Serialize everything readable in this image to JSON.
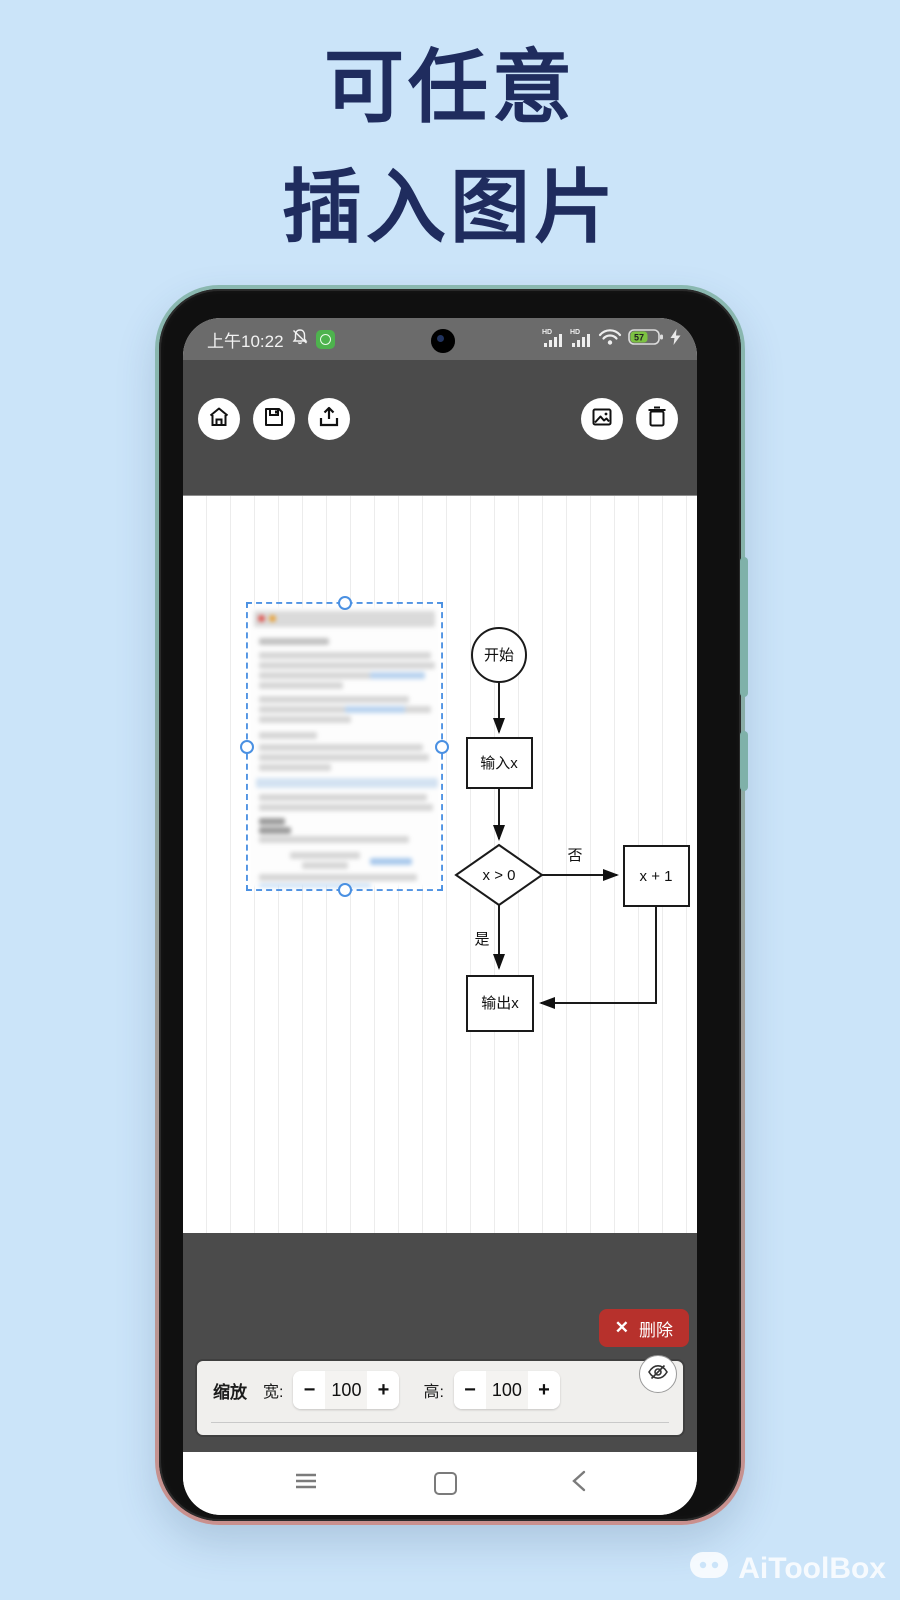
{
  "title": {
    "line1": "可任意",
    "line2": "插入图片"
  },
  "status_bar": {
    "time": "上午10:22",
    "hd": "HD",
    "battery_percent": "57"
  },
  "canvas": {
    "flowchart": {
      "start": "开始",
      "input": "输入x",
      "condition": "x > 0",
      "no": "否",
      "increment": "x + 1",
      "yes": "是",
      "output": "输出x"
    }
  },
  "controls": {
    "delete": {
      "icon": "✕",
      "label": "删除"
    },
    "scale_label": "缩放",
    "width": {
      "label": "宽:",
      "value": "100",
      "minus": "−",
      "plus": "+"
    },
    "height": {
      "label": "高:",
      "value": "100",
      "minus": "−",
      "plus": "+"
    }
  },
  "watermark": {
    "label": "AiToolBox"
  },
  "icons": {
    "left_toolbar": [
      "home-icon",
      "save-icon",
      "upload-icon"
    ],
    "right_toolbar": [
      "image-icon",
      "trash-icon"
    ],
    "nav": [
      "menu-icon",
      "home-square-icon",
      "back-icon"
    ],
    "panel": [
      "eye-off-icon"
    ]
  },
  "colors": {
    "background": "#cbe4f9",
    "title_text": "#1f2c5e",
    "selection_blue": "#4a90e2",
    "delete_red": "#b7312c",
    "dark_chrome": "#4b4b4b",
    "status_bar": "#6b6b6b",
    "battery_green": "#7cc242"
  }
}
